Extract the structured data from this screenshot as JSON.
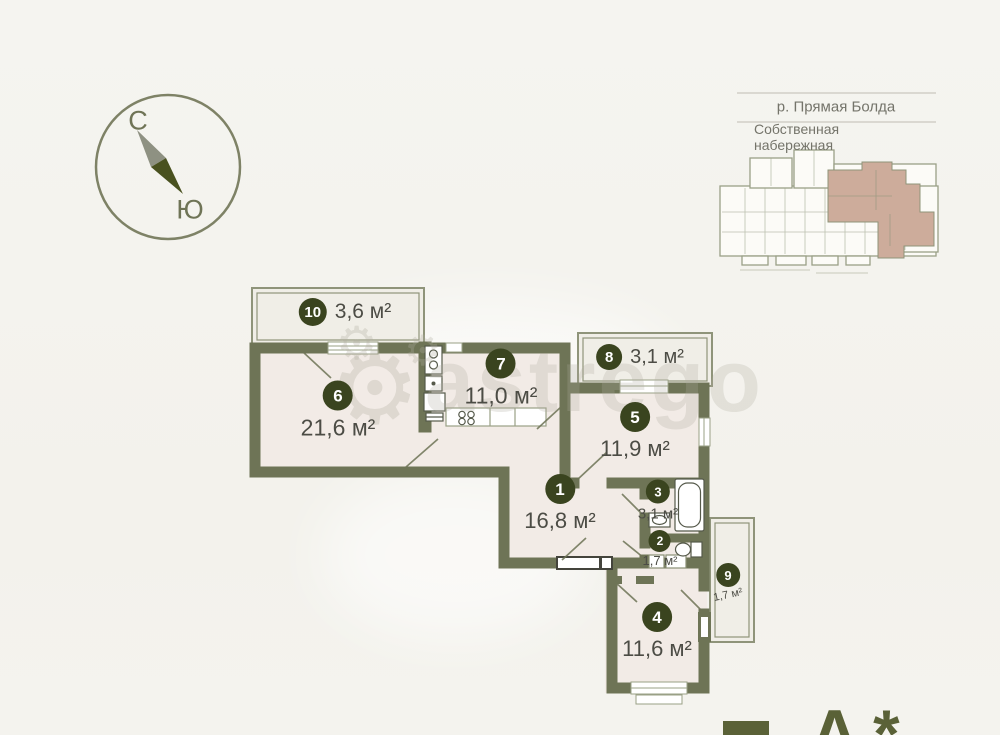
{
  "compass": {
    "north": "С",
    "south": "Ю"
  },
  "site_info": {
    "river": "р. Прямая Болда",
    "embankment": "Собственная набережная"
  },
  "watermark": "astrego",
  "rooms": [
    {
      "number": "1",
      "area": "16,8 м²"
    },
    {
      "number": "2",
      "area": "1,7 м²"
    },
    {
      "number": "3",
      "area": "3,1 м²"
    },
    {
      "number": "4",
      "area": "11,6 м²"
    },
    {
      "number": "5",
      "area": "11,9 м²"
    },
    {
      "number": "6",
      "area": "21,6 м²"
    },
    {
      "number": "7",
      "area": "11,0 м²"
    },
    {
      "number": "8",
      "area": "3,1 м²"
    },
    {
      "number": "9",
      "area": "1,7 м²"
    },
    {
      "number": "10",
      "area": "3,6 м²"
    }
  ],
  "bottom_label": {
    "visible_text": "А*"
  },
  "colors": {
    "wall": "#6e7456",
    "badge": "#3a441f",
    "room_fill": "#f2ebe6",
    "balcony_fill": "#f0eee7",
    "site_highlight": "#cdac9b",
    "label_text": "#4c4c45",
    "accent": "#5a6137"
  }
}
